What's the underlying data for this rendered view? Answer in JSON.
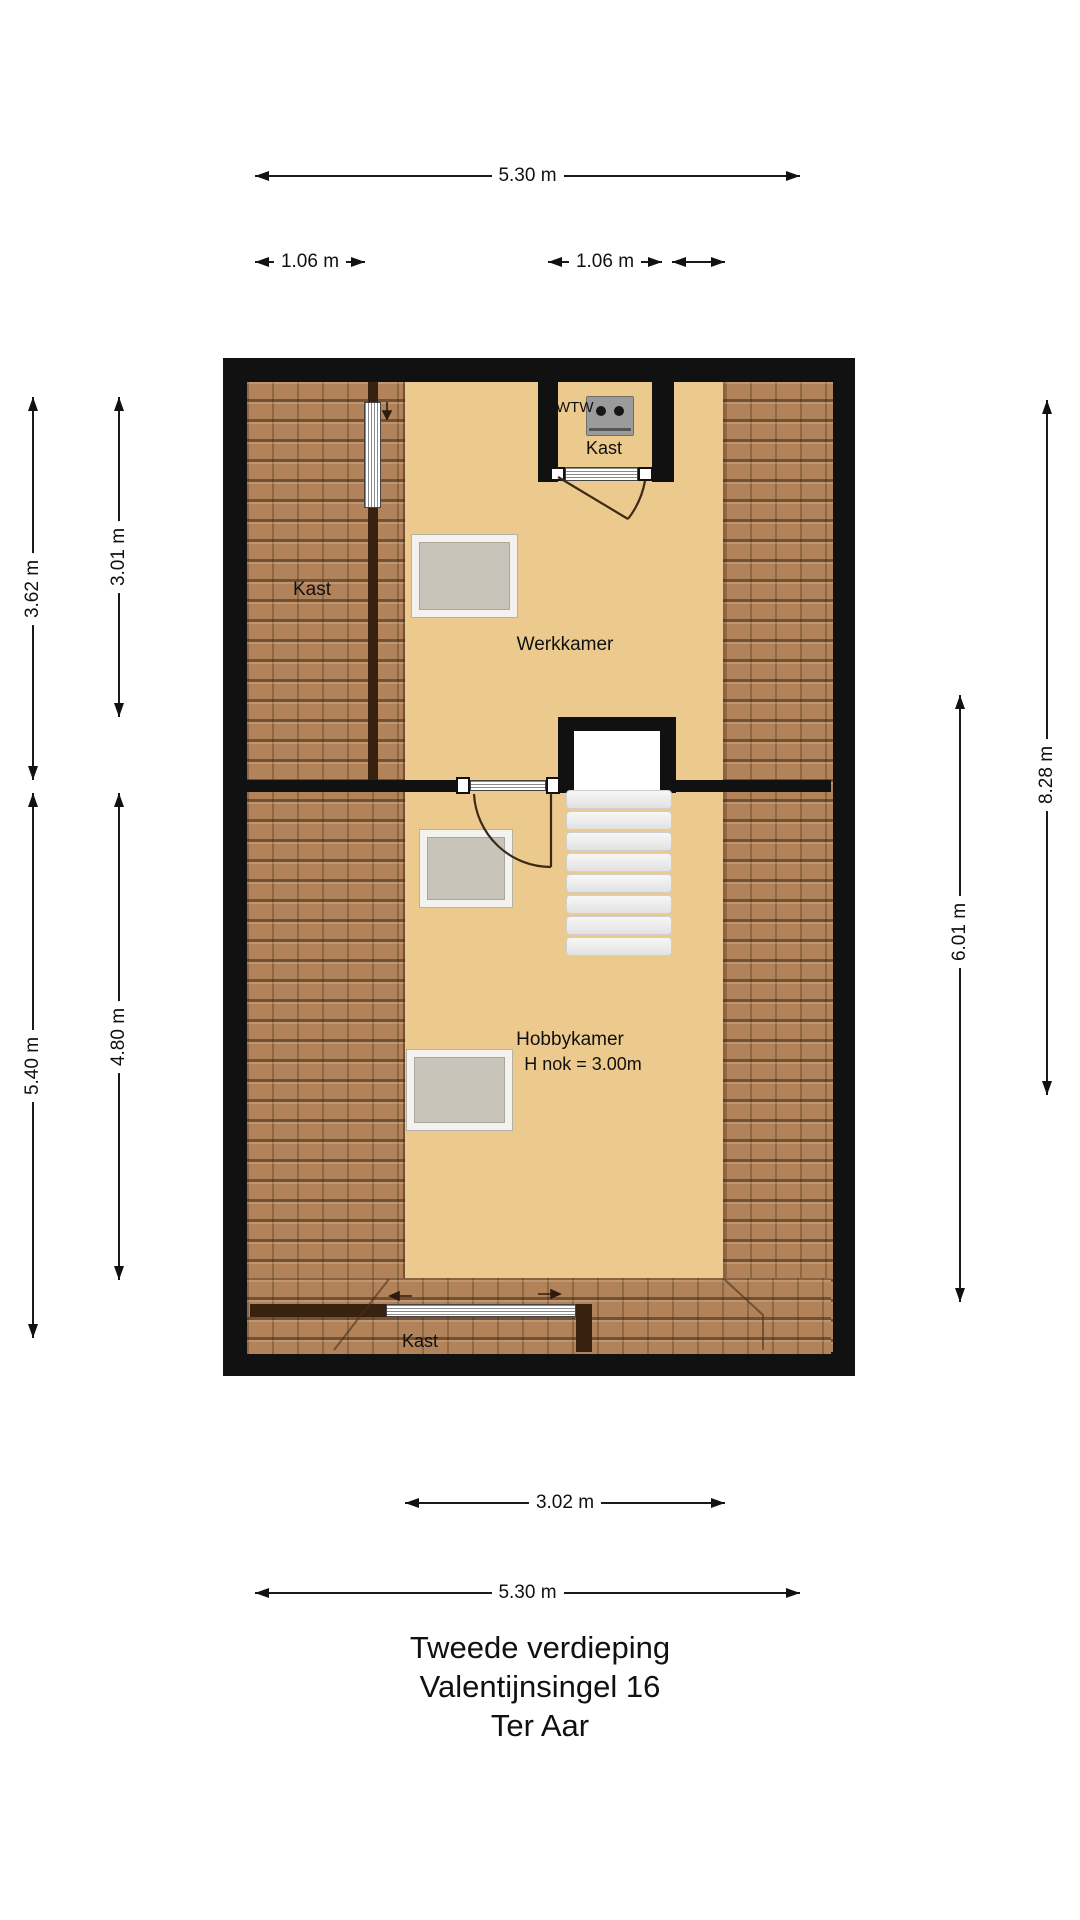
{
  "title": {
    "line1": "Tweede verdieping",
    "line2": "Valentijnsingel 16",
    "line3": "Ter Aar"
  },
  "plan": {
    "rooms": {
      "werkkamer_label": "Werkkamer",
      "hobbykamer_label": "Hobbykamer",
      "hobbykamer_height": "H nok = 3.00m",
      "kast_left_label": "Kast",
      "kast_top_label": "Kast",
      "kast_bottom_label": "Kast",
      "wtw_label": "WTW"
    },
    "features": {
      "stair_tread_count": 8,
      "skylight_count": 3
    },
    "colors": {
      "wall": "#111111",
      "floor": "#ecc98c",
      "roof_tiles": "#b2825a",
      "roof_tile_grout": "#6f5333",
      "inner_wall_dark": "#38220f",
      "skylight_fill": "#c8c4ba",
      "skylight_frame": "#f3f2ef",
      "stair_tread": "#ececec"
    }
  },
  "dimensions": {
    "top_total": "5.30 m",
    "top_left": "1.06 m",
    "top_mid": "1.06 m",
    "left_upper_outer": "3.62 m",
    "left_upper_inner": "3.01 m",
    "left_lower_outer": "5.40 m",
    "left_lower_inner": "4.80 m",
    "right_outer": "8.28 m",
    "right_inner": "6.01 m",
    "bottom_inner": "3.02 m",
    "bottom_total": "5.30 m"
  }
}
